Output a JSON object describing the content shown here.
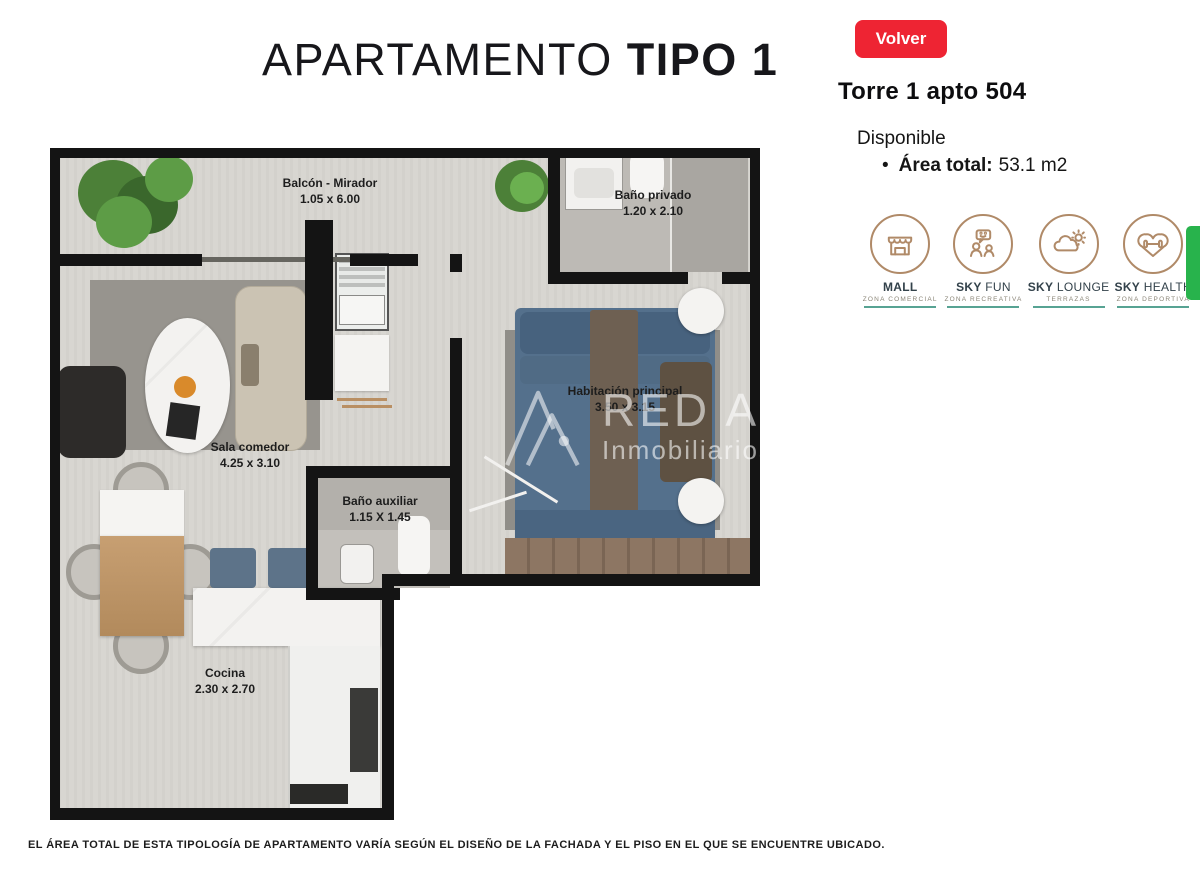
{
  "header": {
    "title_light": "APARTAMENTO",
    "title_bold": "TIPO 1",
    "back_button": "Volver",
    "unit": "Torre 1 apto 504",
    "availability": "Disponible",
    "bullet": "•",
    "area_label": "Área total:",
    "area_value": "53.1 m2"
  },
  "amenities": {
    "items": [
      {
        "bold": "MALL",
        "rest": "",
        "subtitle": "ZONA COMERCIAL",
        "icon": "storefront-icon"
      },
      {
        "bold": "SKY",
        "rest": " FUN",
        "subtitle": "ZONA RECREATIVA",
        "icon": "people-chat-icon"
      },
      {
        "bold": "SKY",
        "rest": " LOUNGE",
        "subtitle": "TERRAZAS",
        "icon": "cloud-sun-icon"
      },
      {
        "bold": "SKY",
        "rest": " HEALTH",
        "subtitle": "ZONA DEPORTIVA",
        "icon": "heart-dumbbell-icon"
      }
    ]
  },
  "floorplan": {
    "rooms": {
      "balcon": {
        "name": "Balcón - Mirador",
        "dims": "1.05 x 6.00"
      },
      "bano_privado": {
        "name": "Baño privado",
        "dims": "1.20 x 2.10"
      },
      "habitacion": {
        "name": "Habitación principal",
        "dims": "3.50 x 3.15"
      },
      "sala": {
        "name": "Sala comedor",
        "dims": "4.25 x 3.10"
      },
      "bano_auxiliar": {
        "name": "Baño auxiliar",
        "dims": "1.15 X 1.45"
      },
      "cocina": {
        "name": "Cocina",
        "dims": "2.30 x 2.70"
      }
    },
    "watermark": {
      "brand": "RED A3",
      "sub": "Inmobiliarios"
    }
  },
  "footer": {
    "disclaimer": "EL ÁREA TOTAL DE ESTA TIPOLOGÍA DE APARTAMENTO VARÍA SEGÚN EL DISEÑO DE LA FACHADA Y EL PISO EN EL QUE SE ENCUENTRE UBICADO."
  },
  "colors": {
    "accent_red": "#ee2433",
    "icon_brown": "#b08a68",
    "underline_teal": "#57a393",
    "green_tab": "#28b34c"
  }
}
